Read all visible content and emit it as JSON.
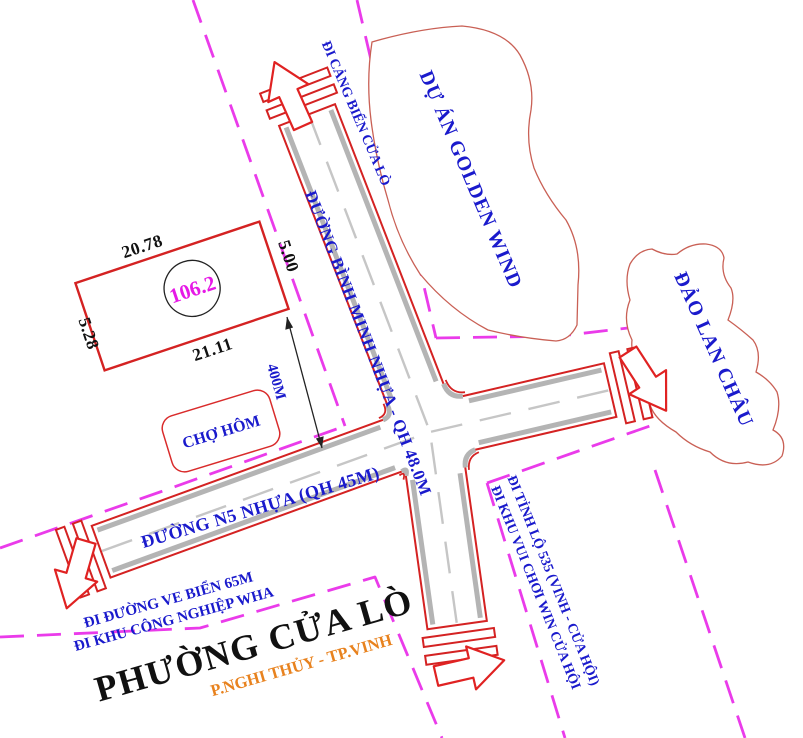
{
  "roads": {
    "binh_minh": {
      "label": "ĐƯỜNG BÌNH MINH NHỰA - QH 48.0M"
    },
    "n5": {
      "label": "ĐƯỜNG N5 NHỰA (QH 45M)"
    }
  },
  "directions": {
    "cang_bien": "ĐI CẢNG BIỂN CỬA LÒ",
    "tinh_lo": "ĐI TỈNH LỘ 535 (VINH - CỬA HỘI)",
    "khu_vui_choi": "ĐI KHU VUI CHƠI WIN CỬA HỘI",
    "ven_bien": "ĐI ĐƯỜNG VE BIỂN 65M",
    "khu_cong_nghiep": "ĐI KHU CÔNG NGHIỆP WHA"
  },
  "areas": {
    "golden_wind": "DỰ ÁN GOLDEN WIND",
    "lan_chau": "ĐẢO LAN CHÂU",
    "cho_hom": "CHỢ HÔM",
    "ward": "PHƯỜNG CỬA LÒ",
    "district": "P.NGHI THỦY - TP.VINH"
  },
  "parcel": {
    "area": "106.2",
    "side_top": "20.78",
    "side_right": "5.00",
    "side_bottom": "21.11",
    "side_left": "5.28",
    "distance_to_road": "400M"
  },
  "colors": {
    "road_edge_red": "#d42222",
    "curb_gray": "#b4b4b4",
    "planning_boundary_magenta": "#ea3bea",
    "label_blue": "#1a1acc",
    "area_number_magenta": "#e619e6",
    "district_orange": "#e8821e",
    "ward_black": "#111111"
  }
}
